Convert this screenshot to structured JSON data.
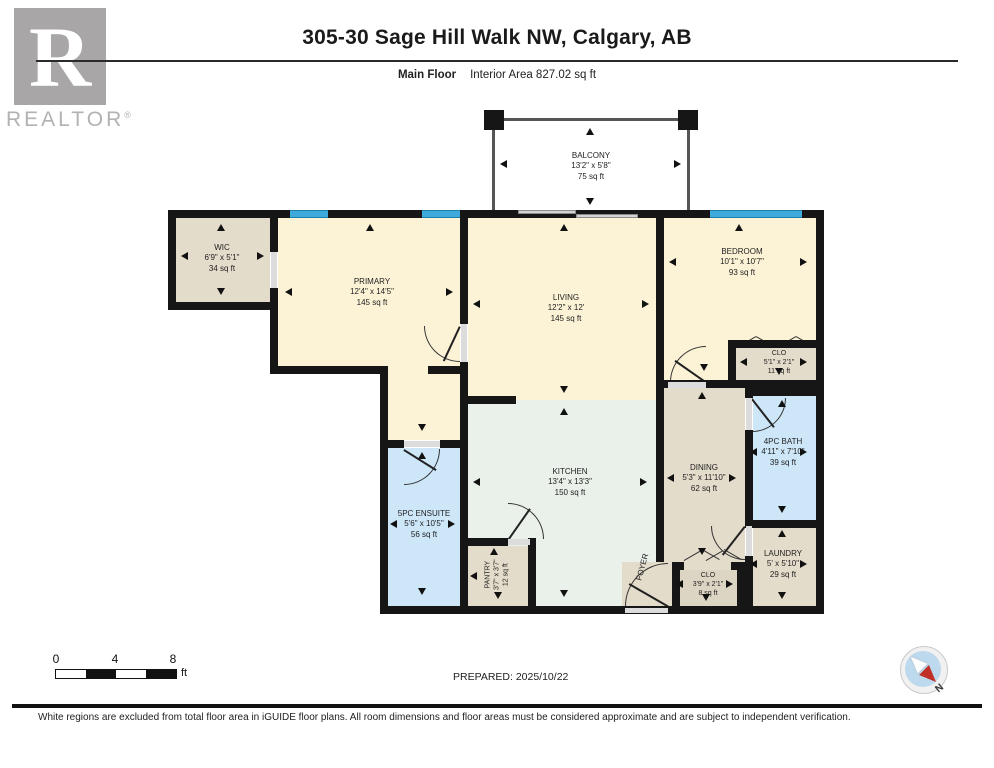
{
  "header": {
    "title": "305-30 Sage Hill Walk NW, Calgary, AB",
    "floor_label": "Main Floor",
    "area_label": "Interior Area 827.02 sq ft"
  },
  "logo": {
    "letter": "R",
    "name": "REALTOR",
    "registered": "®"
  },
  "rooms": {
    "balcony": {
      "name": "BALCONY",
      "dims": "13'2\" x 5'8\"",
      "area": "75 sq ft"
    },
    "wic": {
      "name": "WIC",
      "dims": "6'9\" x 5'1\"",
      "area": "34 sq ft"
    },
    "primary": {
      "name": "PRIMARY",
      "dims": "12'4\" x 14'5\"",
      "area": "145 sq ft"
    },
    "living": {
      "name": "LIVING",
      "dims": "12'2\" x 12'",
      "area": "145 sq ft"
    },
    "bedroom": {
      "name": "BEDROOM",
      "dims": "10'1\" x 10'7\"",
      "area": "93 sq ft"
    },
    "clo_bedroom": {
      "name": "CLO",
      "dims": "5'1\" x 2'1\"",
      "area": "11 sq ft"
    },
    "bath": {
      "name": "4PC BATH",
      "dims": "4'11\" x 7'10\"",
      "area": "39 sq ft"
    },
    "laundry": {
      "name": "LAUNDRY",
      "dims": "5' x 5'10\"",
      "area": "29 sq ft"
    },
    "dining": {
      "name": "DINING",
      "dims": "5'3\" x 11'10\"",
      "area": "62 sq ft"
    },
    "kitchen": {
      "name": "KITCHEN",
      "dims": "13'4\" x 13'3\"",
      "area": "150 sq ft"
    },
    "ensuite": {
      "name": "5PC ENSUITE",
      "dims": "5'6\" x 10'5\"",
      "area": "56 sq ft"
    },
    "pantry": {
      "name": "PANTRY",
      "dims": "3'7\" x 3'7\"",
      "area": "12 sq ft"
    },
    "clo_foyer": {
      "name": "CLO",
      "dims": "3'9\" x 2'1\"",
      "area": "8 sq ft"
    },
    "foyer": {
      "name": "FOYER"
    }
  },
  "scale_bar": {
    "tick0": "0",
    "tick1": "4",
    "tick2": "8",
    "unit": "ft"
  },
  "prepared_label": "PREPARED: 2025/10/22",
  "compass": {
    "north_label": "N"
  },
  "footer_note": "White regions are excluded from total floor area in iGUIDE floor plans. All room dimensions and floor areas must be considered approximate and are subject to independent verification.",
  "colors": {
    "wall": "#161616",
    "window_blue": "#3fa9dc",
    "room_yellow": "#fcf3d6",
    "room_tan": "#e4dcca",
    "room_blue": "#cde7f9",
    "room_mint": "#e9f1ea"
  }
}
